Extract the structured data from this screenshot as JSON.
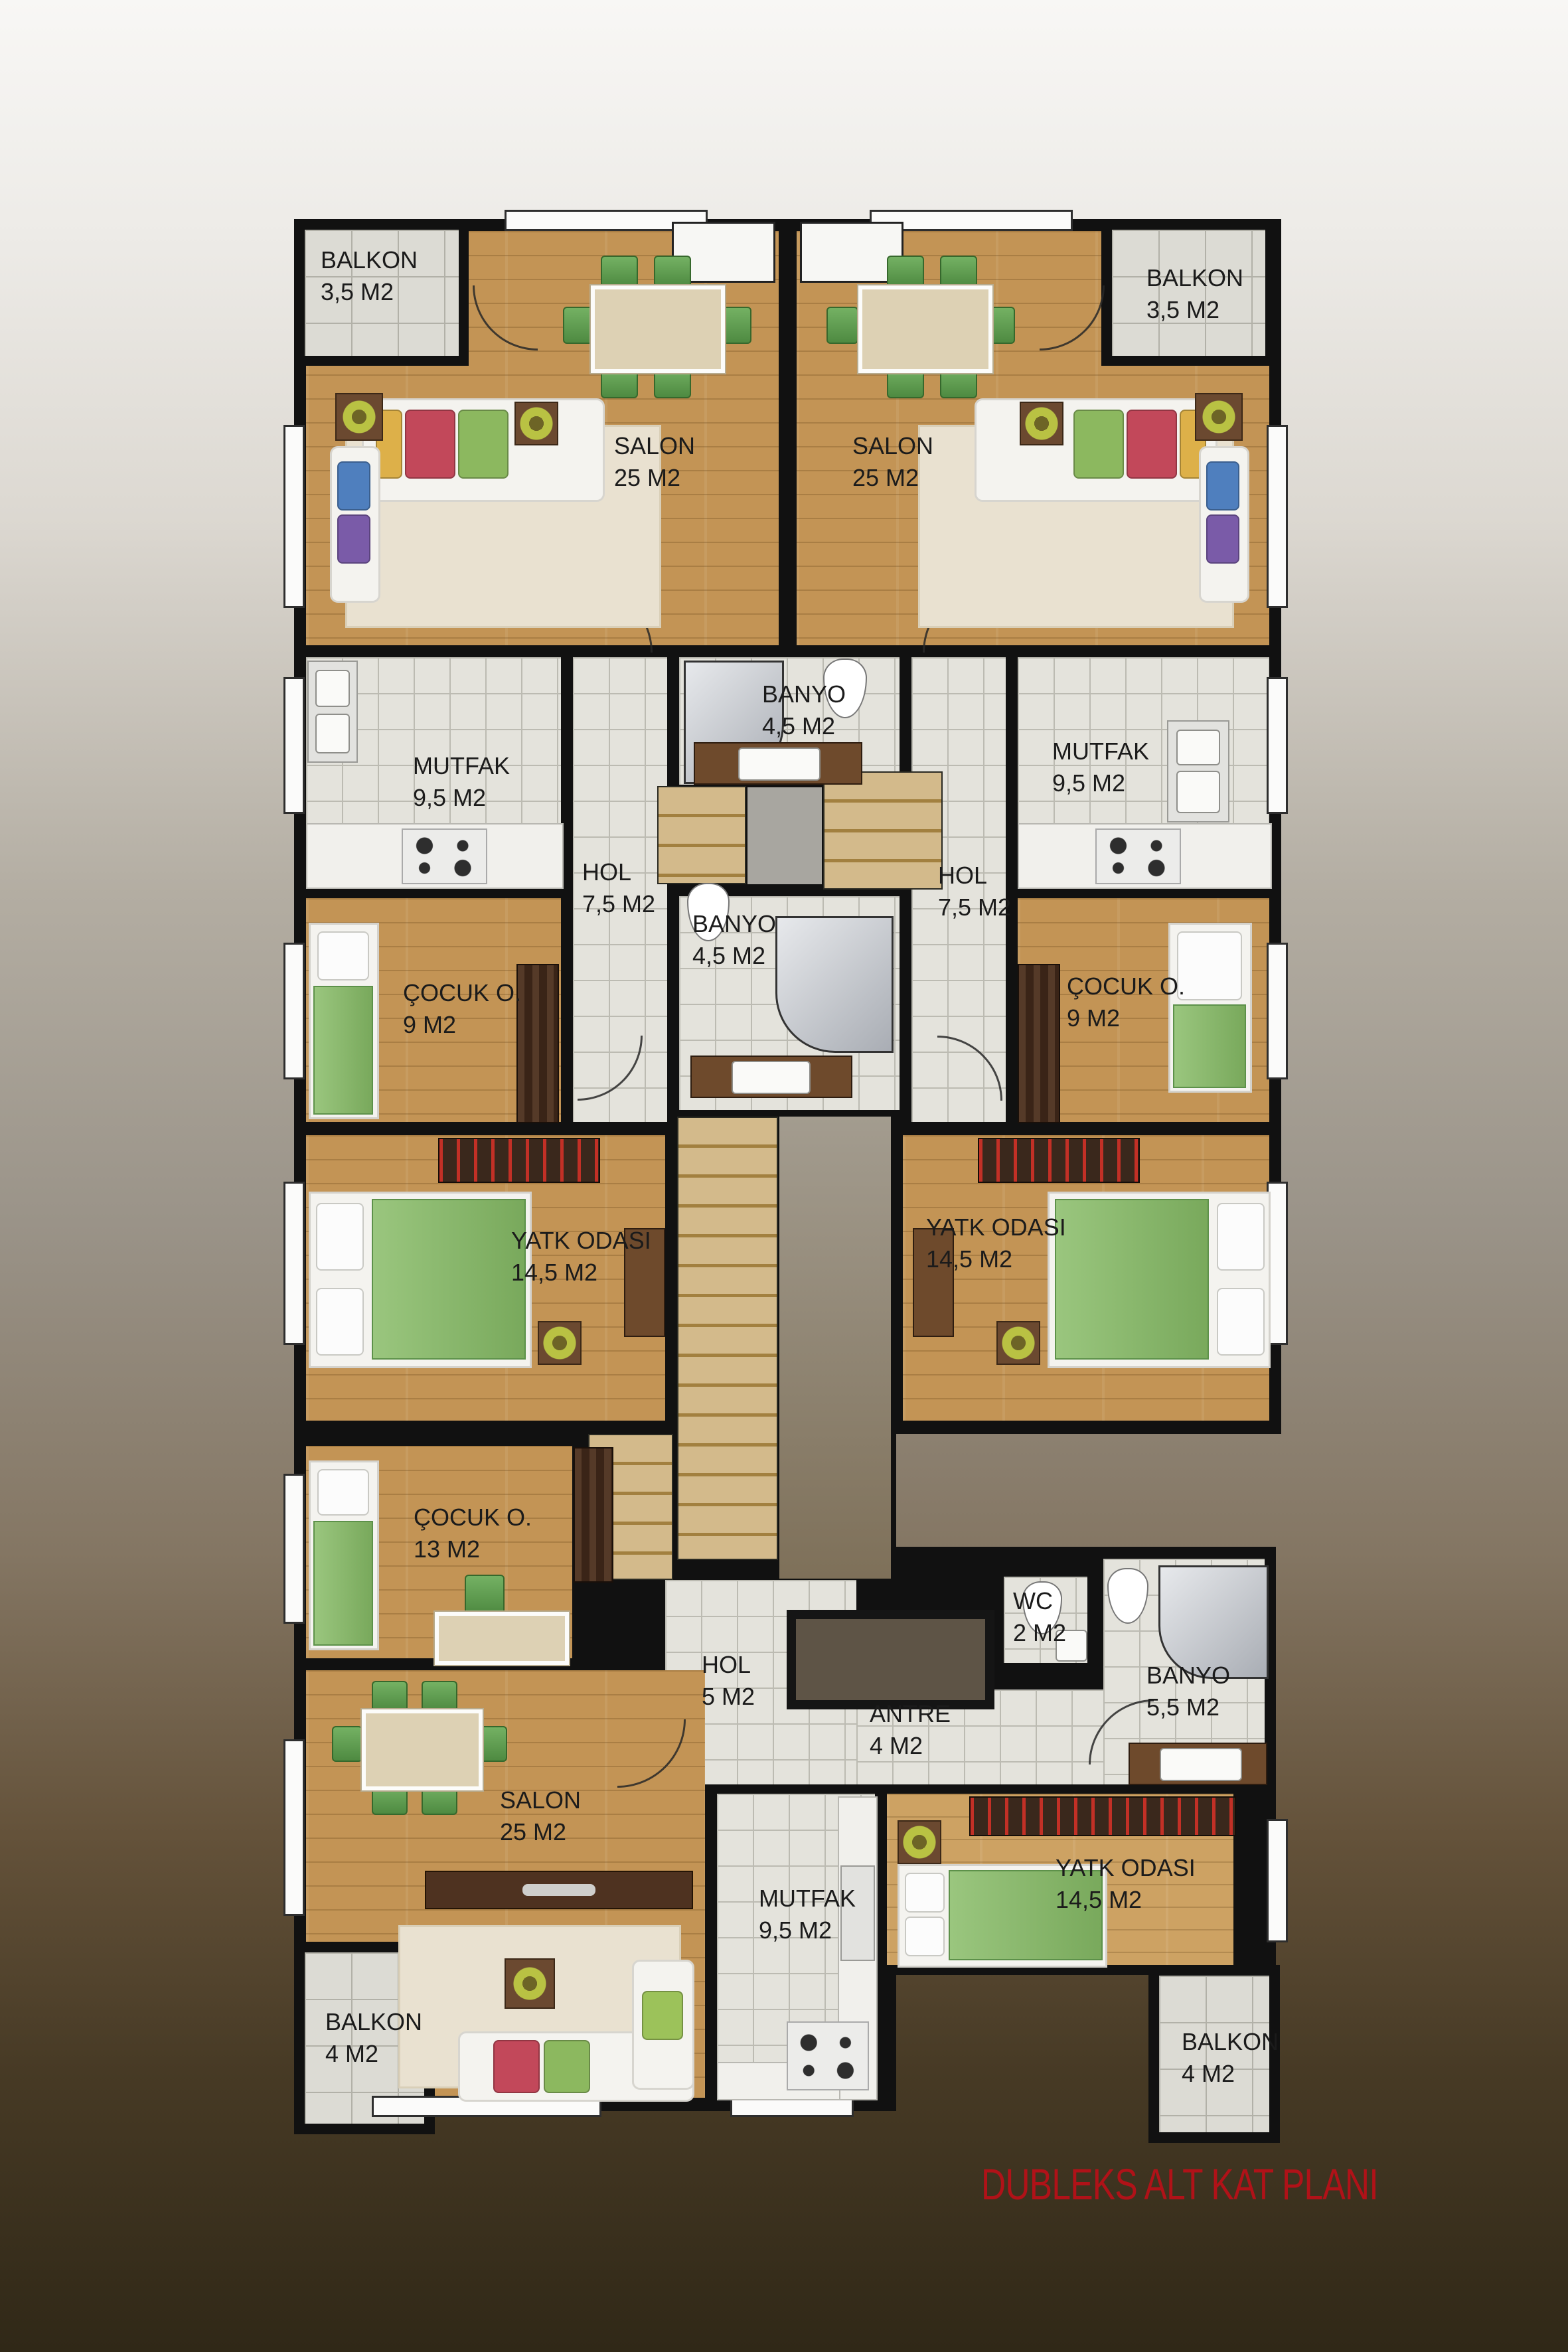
{
  "title": {
    "text": "DUBLEKS ALT KAT PLANI",
    "color": "#b01218"
  },
  "plan": {
    "type": "apartment-floor-plan",
    "language": "Turkish"
  },
  "rooms": [
    {
      "key": "balkon-top-left",
      "name": "BALKON",
      "area": "3,5 M2"
    },
    {
      "key": "salon-top-left",
      "name": "SALON",
      "area": "25 M2"
    },
    {
      "key": "salon-top-right",
      "name": "SALON",
      "area": "25 M2"
    },
    {
      "key": "balkon-top-right",
      "name": "BALKON",
      "area": "3,5 M2"
    },
    {
      "key": "mutfak-left",
      "name": "MUTFAK",
      "area": "9,5 M2"
    },
    {
      "key": "banyo-top",
      "name": "BANYO",
      "area": "4,5 M2"
    },
    {
      "key": "mutfak-right",
      "name": "MUTFAK",
      "area": "9,5 M2"
    },
    {
      "key": "hol-left",
      "name": "HOL",
      "area": "7,5 M2"
    },
    {
      "key": "hol-right",
      "name": "HOL",
      "area": "7,5 M2"
    },
    {
      "key": "banyo-mid",
      "name": "BANYO",
      "area": "4,5 M2"
    },
    {
      "key": "cocuk-odasi-left",
      "name": "ÇOCUK O.",
      "area": "9 M2"
    },
    {
      "key": "cocuk-odasi-right",
      "name": "ÇOCUK O.",
      "area": "9 M2"
    },
    {
      "key": "yatak-odasi-left",
      "name": "YATK ODASI",
      "area": "14,5 M2"
    },
    {
      "key": "yatak-odasi-right",
      "name": "YATK ODASI",
      "area": "14,5 M2"
    },
    {
      "key": "cocuk-odasi-13",
      "name": "ÇOCUK O.",
      "area": "13 M2"
    },
    {
      "key": "hol-5",
      "name": "HOL",
      "area": "5 M2"
    },
    {
      "key": "antre",
      "name": "ANTRE",
      "area": "4 M2"
    },
    {
      "key": "wc",
      "name": "WC",
      "area": "2 M2"
    },
    {
      "key": "banyo-55",
      "name": "BANYO",
      "area": "5,5 M2"
    },
    {
      "key": "salon-bottom",
      "name": "SALON",
      "area": "25 M2"
    },
    {
      "key": "mutfak-bottom",
      "name": "MUTFAK",
      "area": "9,5 M2"
    },
    {
      "key": "yatak-odasi-bottom",
      "name": "YATK ODASI",
      "area": "14,5 M2"
    },
    {
      "key": "balkon-bottom-left",
      "name": "BALKON",
      "area": "4 M2"
    },
    {
      "key": "balkon-bottom-right",
      "name": "BALKON",
      "area": "4 M2"
    }
  ],
  "colors": {
    "wall": "#111111",
    "wood": "#c39455",
    "tile": "#e4e3dc",
    "balcony": "#dcdbd4",
    "title": "#b01218"
  }
}
